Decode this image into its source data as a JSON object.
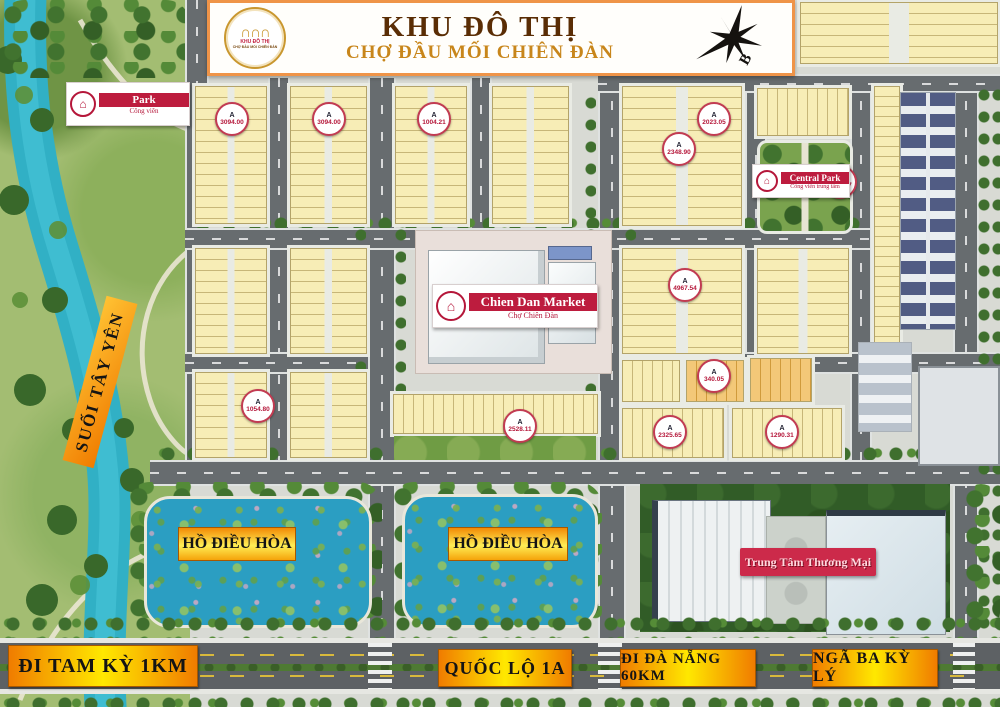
{
  "banner": {
    "title": "KHU ĐÔ THỊ",
    "subtitle": "CHỢ ĐẦU MỐI CHIÊN ĐÀN"
  },
  "logo": {
    "arches": "∩∩∩",
    "line1": "KHU ĐÔ THỊ",
    "line2": "CHỢ ĐẦU MỐI CHIÊN ĐÀN"
  },
  "compass": {
    "north": "B"
  },
  "places": {
    "park_title": "Park",
    "park_sub": "Công viên",
    "central_park_title": "Central Park",
    "central_park_sub": "Công viên trung tâm",
    "market_title": "Chien Dan Market",
    "market_sub": "Chợ Chiên Đàn",
    "mall_title": "Trung Tâm Thương Mại",
    "stream": "SUỐI TÂY YÊN",
    "lake_left": "HỒ ĐIỀU HÒA",
    "lake_right": "HỒ ĐIỀU HÒA",
    "logo_glyph": "⌂"
  },
  "roads": {
    "tam_ky": "ĐI TAM KỲ 1KM",
    "ql1a": "QUỐC LỘ 1A",
    "da_nang": "ĐI ĐÀ NẴNG 60KM",
    "ky_ly": "NGÃ BA KỲ LÝ"
  },
  "block_badges": [
    {
      "label": "A",
      "area": "3094.00",
      "x": 230,
      "y": 117
    },
    {
      "label": "A",
      "area": "3094.00",
      "x": 327,
      "y": 117
    },
    {
      "label": "A",
      "area": "1004.21",
      "x": 432,
      "y": 117
    },
    {
      "label": "A",
      "area": "2023.05",
      "x": 712,
      "y": 117
    },
    {
      "label": "A",
      "area": "2348.90",
      "x": 677,
      "y": 147
    },
    {
      "label": "A",
      "area": "2501.57",
      "x": 838,
      "y": 180
    },
    {
      "label": "A",
      "area": "4967.54",
      "x": 683,
      "y": 283
    },
    {
      "label": "A",
      "area": "1054.80",
      "x": 256,
      "y": 404
    },
    {
      "label": "A",
      "area": "2528.11",
      "x": 518,
      "y": 424
    },
    {
      "label": "A",
      "area": "340.05",
      "x": 712,
      "y": 374
    },
    {
      "label": "A",
      "area": "2325.65",
      "x": 668,
      "y": 430
    },
    {
      "label": "A",
      "area": "1290.31",
      "x": 780,
      "y": 430
    }
  ],
  "sample_lot_labels": [
    "24 120.00",
    "23 120.00",
    "22 120.00",
    "21 120.00",
    "20 120.00",
    "19 120.00",
    "18 120.00",
    "17 120.00",
    "16 120.00",
    "1 180.00",
    "8 120.00"
  ],
  "colors": {
    "lot_yellow": "#f7edb6",
    "lot_orange": "#f3c878",
    "road_gray": "#676c6f",
    "river_blue": "#31b0c5",
    "lake_blue": "#2b9ec2",
    "grass_green": "#a3bd72",
    "tree_green": "#3f6f2e",
    "sign_red": "#bd1c3e",
    "banner_border_orange": "#ef9448",
    "gold": "#c8861b",
    "label_gradient": [
      "#f07c00",
      "#ffe800"
    ]
  }
}
